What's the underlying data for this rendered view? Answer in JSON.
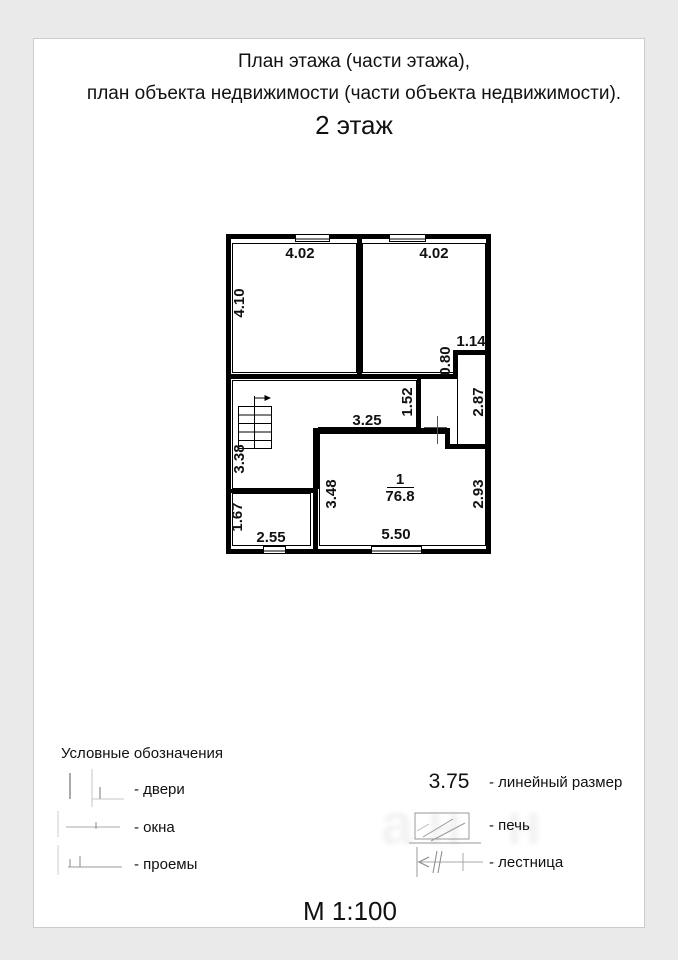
{
  "titles": {
    "line1": "План этажа (части этажа),",
    "line2": "план объекта недвижимости (части объекта недвижимости).",
    "line3": "2 этаж"
  },
  "plan": {
    "room1_width": "4.02",
    "room2_width": "4.02",
    "room1_height": "4.10",
    "notch_width": "1.14",
    "notch_height": "0.80",
    "corridor_height": "2.87",
    "passage_height": "1.52",
    "hall_width": "3.25",
    "stair_side": "3.38",
    "bigroom_left_height": "3.48",
    "bigroom_right_height": "2.93",
    "smallroom_height": "1.67",
    "smallroom_width": "2.55",
    "bigroom_width": "5.50",
    "room_number": "1",
    "room_area": "76.8"
  },
  "legend": {
    "heading": "Условные обозначения",
    "doors_label": "- двери",
    "windows_label": "- окна",
    "openings_label": "- проемы",
    "dimension_sample": "3.75",
    "dimension_label": "- линейный размер",
    "stove_label": "- печь",
    "stairs_label": "- лестница"
  },
  "footer": {
    "scale_label": "М 1:100"
  },
  "watermark": "ан н",
  "colors": {
    "wall_line": "#000000",
    "legend_line": "#9a9a9a",
    "page_bg": "#ffffff",
    "canvas_bg": "#eaeaea"
  }
}
